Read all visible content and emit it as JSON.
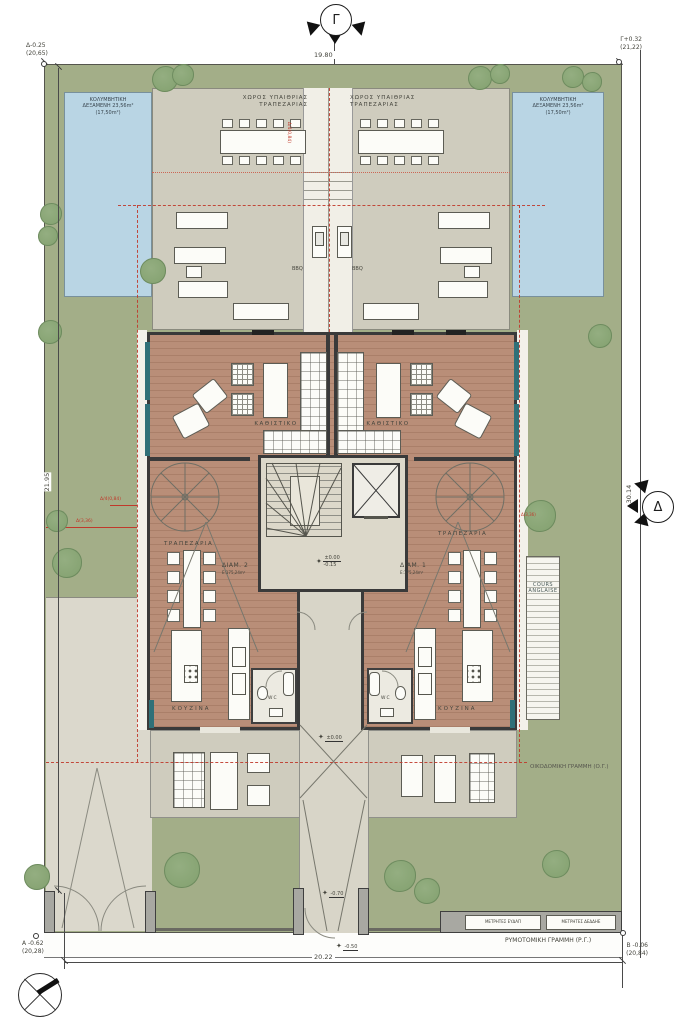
{
  "drawing": {
    "section_marker_top": "Γ",
    "section_marker_right": "Δ",
    "corner_top_left_label": "Δ-0.25",
    "corner_top_left_elev": "(20,65)",
    "corner_top_right_label": "Γ+0.32",
    "corner_top_right_elev": "(21,22)",
    "corner_bottom_left_label": "Α -0.62",
    "corner_bottom_left_elev": "(20,28)",
    "corner_bottom_right_label": "Β -0.06",
    "corner_bottom_right_elev": "(20,84)",
    "dim_top": "19.80",
    "dim_bottom": "20.22",
    "dim_left": "21.95",
    "dim_right": "30.14",
    "setback_left_quarter": "Δ/4(0,84)",
    "setback_left_full": "Δ(3,36)",
    "setback_center": "Δ/4(0,84)",
    "setback_right": "Δ(3,36)",
    "level_core_top": "±0.00",
    "level_core_bottom": "-0.15",
    "level_entry": "±0.00",
    "level_porch": "-0.70",
    "level_street": "-0.50"
  },
  "site": {
    "pool_left": {
      "l1": "ΚΟΛΥΜΒΗΤΙΚΗ",
      "l2": "ΔΕΞΑΜΕΝΗ 23,56m²",
      "l3": "(17,50m²)"
    },
    "pool_right": {
      "l1": "ΚΟΛΥΜΒΗΤΙΚΗ",
      "l2": "ΔΕΞΑΜΕΝΗ 23,56m²",
      "l3": "(17,50m²)"
    },
    "outdoor_dining_left": {
      "l1": "ΧΩΡΟΣ ΥΠΑΙΘΡΙΑΣ",
      "l2": "ΤΡΑΠΕΖΑΡΙΑΣ"
    },
    "outdoor_dining_right": {
      "l1": "ΧΩΡΟΣ ΥΠΑΙΘΡΙΑΣ",
      "l2": "ΤΡΑΠΕΖΑΡΙΑΣ"
    },
    "bbq_left": "BBQ",
    "bbq_right": "BBQ",
    "building_line": "ΟΙΚΟΔΟΜΙΚΗ ΓΡΑΜΜΗ (Ο.Γ.)",
    "street_line": "ΡΥΜΟΤΟΜΙΚΗ ΓΡΑΜΜΗ (Ρ.Γ.)",
    "meter_water": "ΜΕΤΡΗΤΕΣ ΕΥΔΑΠ",
    "meter_power": "ΜΕΤΡΗΤΕΣ ΔΕΔΔΗΕ",
    "cours": {
      "l1": "COURS",
      "l2": "ANGLAISE"
    }
  },
  "apartments": {
    "left": {
      "id": "ΔΙΑΜ. 2",
      "area": "Ε:175,24m²",
      "living": "ΚΑΘΙΣΤΙΚΟ",
      "dining": "ΤΡΑΠΕΖΑΡΙΑ",
      "kitchen": "ΚΟΥΖΙΝΑ",
      "wc": "WC"
    },
    "right": {
      "id": "ΔΙΑΜ. 1",
      "area": "Ε:175,24m²",
      "living": "ΚΑΘΙΣΤΙΚΟ",
      "dining": "ΤΡΑΠΕΖΑΡΙΑ",
      "kitchen": "ΚΟΥΖΙΝΑ",
      "wc": "WC"
    }
  },
  "colors": {
    "lawn": "#a3ae88",
    "paving": "#cfccbe",
    "deck": "#b98e78",
    "pool": "#b9d5e4",
    "tree": "#8aa578",
    "red_line": "#c0392b",
    "wall": "#3a3a3a",
    "teal": "#2f7078"
  }
}
